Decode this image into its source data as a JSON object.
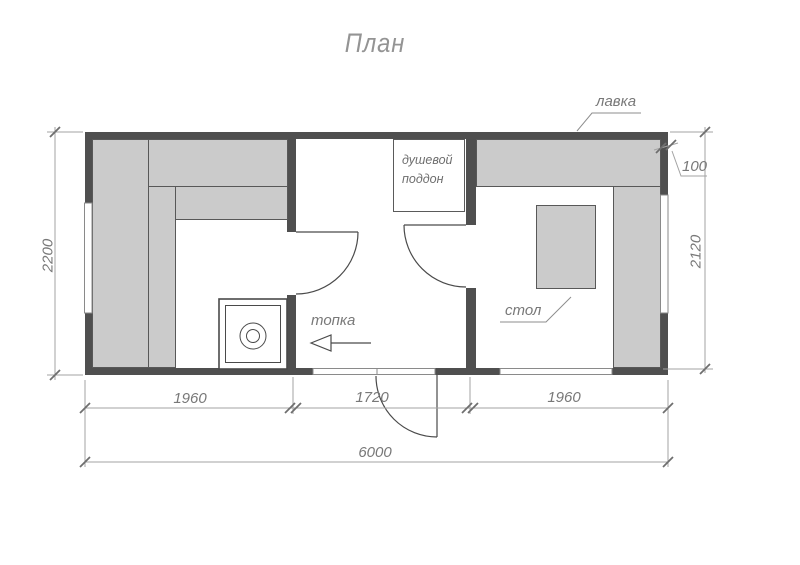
{
  "title": "План",
  "labels": {
    "bench": "лавка",
    "shower_tray": [
      "душевой",
      "поддон"
    ],
    "firebox": "топка",
    "table": "стол"
  },
  "dimensions": {
    "room_left_width": "1960",
    "room_middle_width": "1720",
    "room_right_width": "1960",
    "total_width": "6000",
    "left_height": "2200",
    "right_height": "2120",
    "bench_offset": "100"
  },
  "colors": {
    "wall": "#4f4f4f",
    "furniture_fill": "#cbcbcb",
    "dimension_line": "#a3a3a3",
    "tick": "#6e6e6e",
    "text": "#787878"
  }
}
